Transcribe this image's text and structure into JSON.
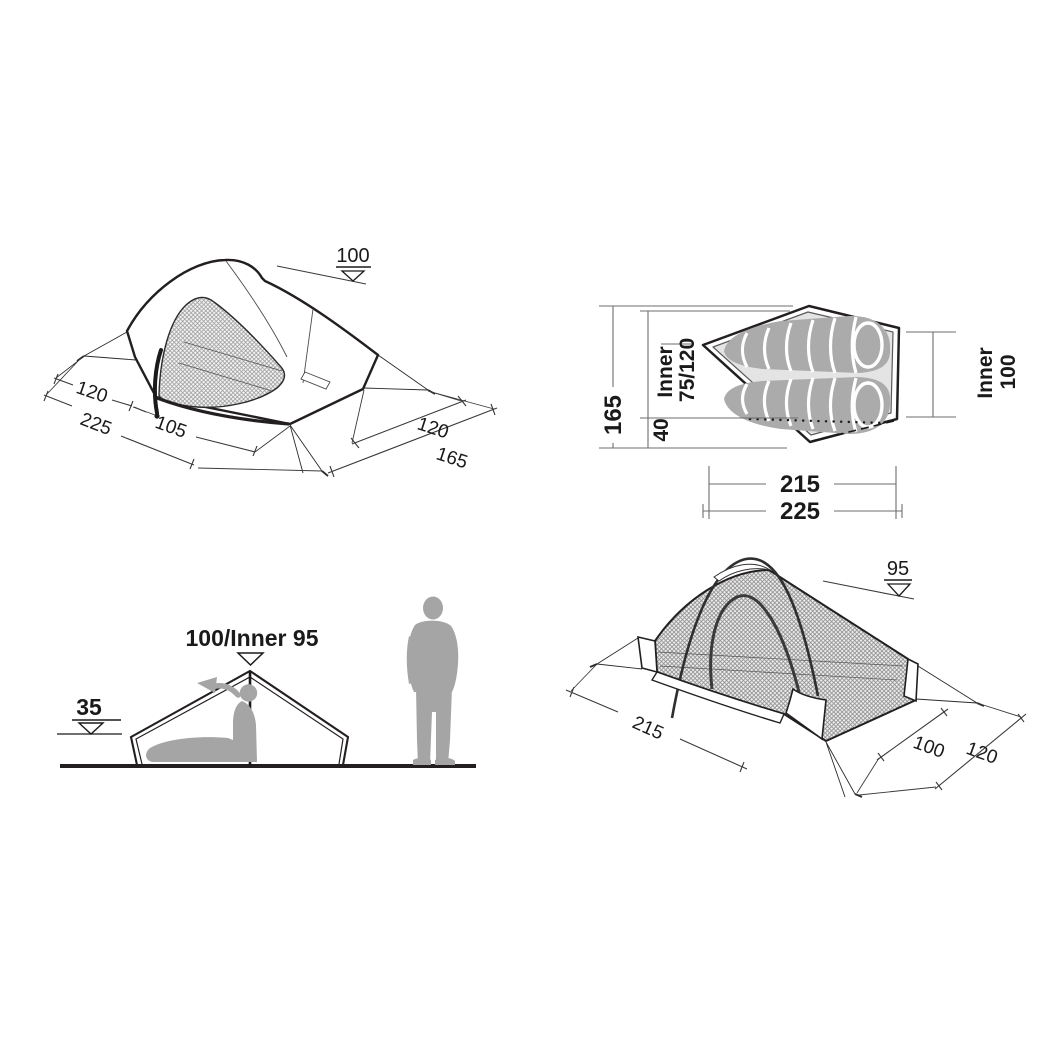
{
  "figure": {
    "background": "#ffffff",
    "colors": {
      "line": "#231f20",
      "dimension_line": "#3a3a3a",
      "silhouette_gray": "#a5a5a5",
      "inner_floor_gray": "#e4e4e4",
      "sleeping_bag_gray": "#ababab"
    },
    "views": {
      "outer_perspective": {
        "title": "outer-tent-perspective-view",
        "labels": {
          "height": "100",
          "left_width": "120",
          "total_length": "225",
          "door_width": "105",
          "right_width": "120",
          "right_length": "165"
        }
      },
      "floor_plan": {
        "title": "floor-plan-top-view",
        "labels": {
          "total_width": "165",
          "inner_width_label": "Inner",
          "inner_width_value": "75/120",
          "vestibule_depth": "40",
          "inner_len_label": "Inner",
          "inner_len_value": "100",
          "inner_length": "215",
          "total_length": "225"
        }
      },
      "side_elevation": {
        "title": "side-elevation-view",
        "labels": {
          "peak_height": "100/Inner 95",
          "wall_height": "35"
        }
      },
      "inner_perspective": {
        "title": "inner-tent-perspective-view",
        "labels": {
          "height": "95",
          "length": "215",
          "width_inner": "100",
          "width_outer": "120"
        }
      }
    }
  }
}
